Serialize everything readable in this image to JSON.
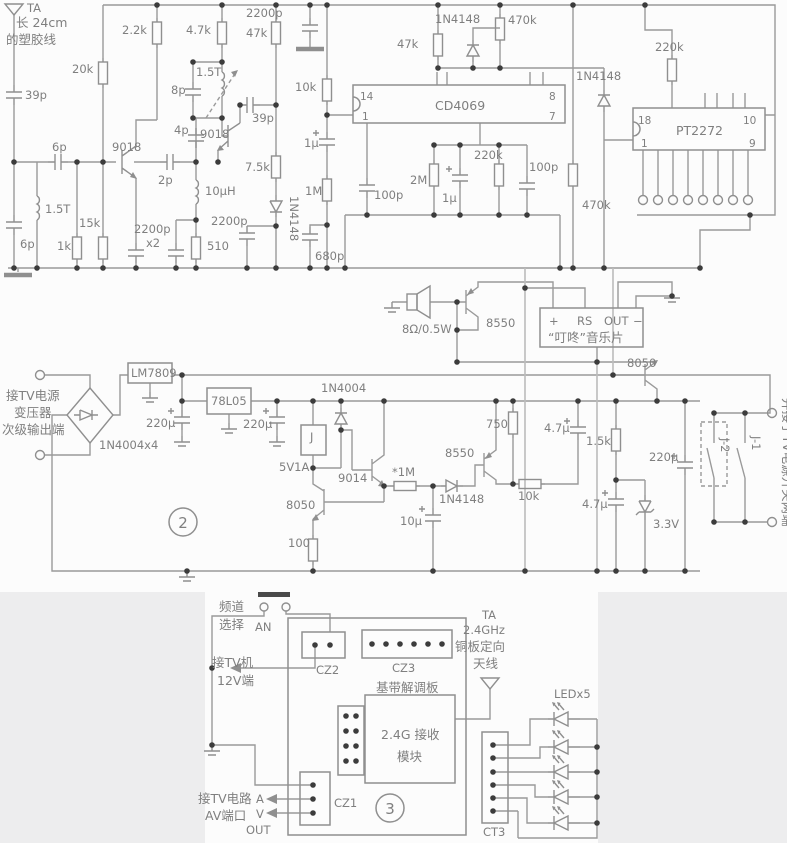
{
  "colors": {
    "wire": "#9a9a9a",
    "light_wire": "#bcbcbc",
    "text": "#7f7f7f",
    "dot": "#3c3c3c",
    "panel": "#ededee",
    "background": "#fcfcfc"
  },
  "top": {
    "ta": "TA",
    "note1": "长 24cm",
    "note2": "的塑胶线",
    "c39p": "39p",
    "c6p_s": "6p",
    "l15t1": "1.5T",
    "c6p_b": "6p",
    "r1k": "1k",
    "r15k": "15k",
    "r20k": "20k",
    "r22k": "2.2k",
    "q1": "9018",
    "c2200p_x2": "2200p",
    "x2": "x2",
    "r510": "510",
    "l10uh": "10μH",
    "c2p": "2p",
    "c4p": "4p",
    "c8p": "8p",
    "l15t2": "1.5T",
    "q2": "9018",
    "c39p2": "39p",
    "r47k_l": "4.7k",
    "r47k": "47k",
    "r75k": "7.5k",
    "d1": "1N4148",
    "c2200p_b": "2200p",
    "c2200p_t": "2200p",
    "r10k": "10k",
    "c1u_a": "1μ",
    "r1m": "1M",
    "c680p": "680p",
    "c100p_a": "100p",
    "ic1": "CD4069",
    "p14": "14",
    "p1": "1",
    "p8": "8",
    "p7": "7",
    "r47k_b": "47k",
    "d2": "1N4148",
    "r470k_a": "470k",
    "r2m": "2M",
    "c1u_b": "1μ",
    "r220k_a": "220k",
    "c100p_b": "100p",
    "d3": "1N4148",
    "r220k_b": "220k",
    "r470k_b": "470k",
    "ic2": "PT2272",
    "p18": "18",
    "p1b": "1",
    "p10": "10",
    "p9": "9"
  },
  "middle": {
    "spk": "8Ω/0.5W",
    "q3": "8550",
    "mc_p": "+",
    "mc_rs": "RS",
    "mc_out": "OUT",
    "mc_m": "−",
    "mc_name": "“叮咚”音乐片",
    "q4": "8050",
    "in1": "接TV电源",
    "in2": "变压器",
    "in3": "次级输出端",
    "bridge": "1N4004x4",
    "reg1": "LM7809",
    "c220u_a": "220μ",
    "reg2": "78L05",
    "c220u_b": "220μ",
    "d4": "1N4004",
    "relay": "J",
    "rating": "5V1A",
    "q5": "8050",
    "r100": "100",
    "q6": "9014",
    "r1m": "*1M",
    "c10u": "10μ",
    "d5": "1N4148",
    "q7": "8550",
    "r750": "750",
    "r10k": "10k",
    "c47u_a": "4.7μ",
    "r15k": "1.5k",
    "c220u_c": "220μ",
    "c47u_b": "4.7μ",
    "dz": "3.3V",
    "j1": "J-1",
    "j2": "J-2",
    "note": "并接于TV电源开关两端",
    "num": "2"
  },
  "bottom": {
    "ch1": "频道",
    "ch2": "选择",
    "an": "AN",
    "cz2": "CZ2",
    "cz3": "CZ3",
    "board": "基带解调板",
    "mod1": "2.4G 接收",
    "mod2": "模块",
    "tv1": "接TV机",
    "tv2": "12V端",
    "av1": "接TV电路",
    "av2": "AV端口",
    "a": "A",
    "v": "V",
    "out": "OUT",
    "cz1": "CZ1",
    "num": "3",
    "ta": "TA",
    "ta2": "2.4GHz",
    "ta3": "铜板定向",
    "ta4": "天线",
    "led": "LEDx5",
    "ct3": "CT3"
  }
}
